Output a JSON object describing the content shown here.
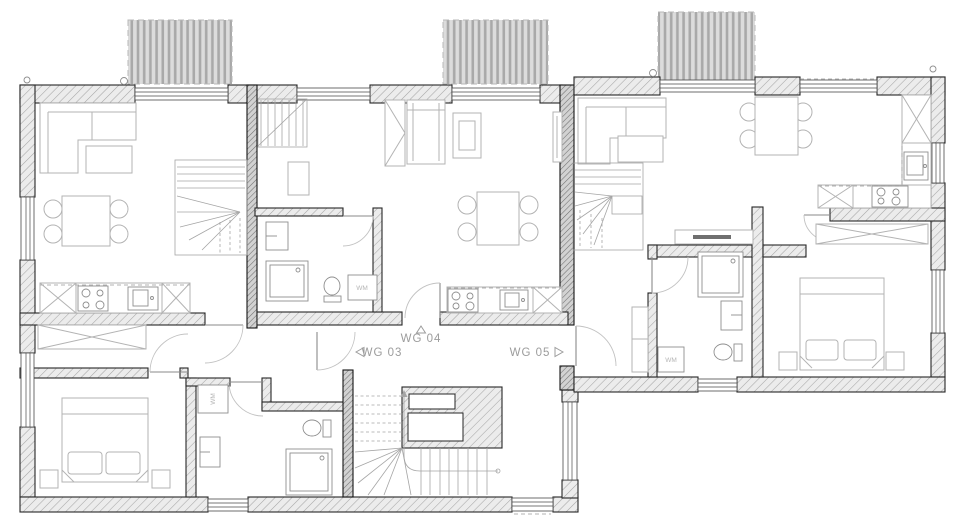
{
  "document": {
    "type": "architectural floor plan"
  },
  "units": [
    {
      "id": "wg03",
      "label": "WG 03",
      "entrance_direction": "left"
    },
    {
      "id": "wg04",
      "label": "WG 04",
      "entrance_direction": "up"
    },
    {
      "id": "wg05",
      "label": "WG 05",
      "entrance_direction": "right"
    }
  ],
  "appliance_labels": {
    "washing_machine": "WM"
  },
  "colors": {
    "background": "#ffffff",
    "wall_outline": "#262626",
    "wall_hatch_line": "#a6a6a6",
    "wall_fill": "#ececec",
    "dark_wall_fill": "#d2d2d2",
    "furniture_line": "#b3b3b3",
    "fixture_line": "#8e8e8e",
    "label_text": "#9c9c9c",
    "balcony_stripe": "#a9a9a9"
  }
}
